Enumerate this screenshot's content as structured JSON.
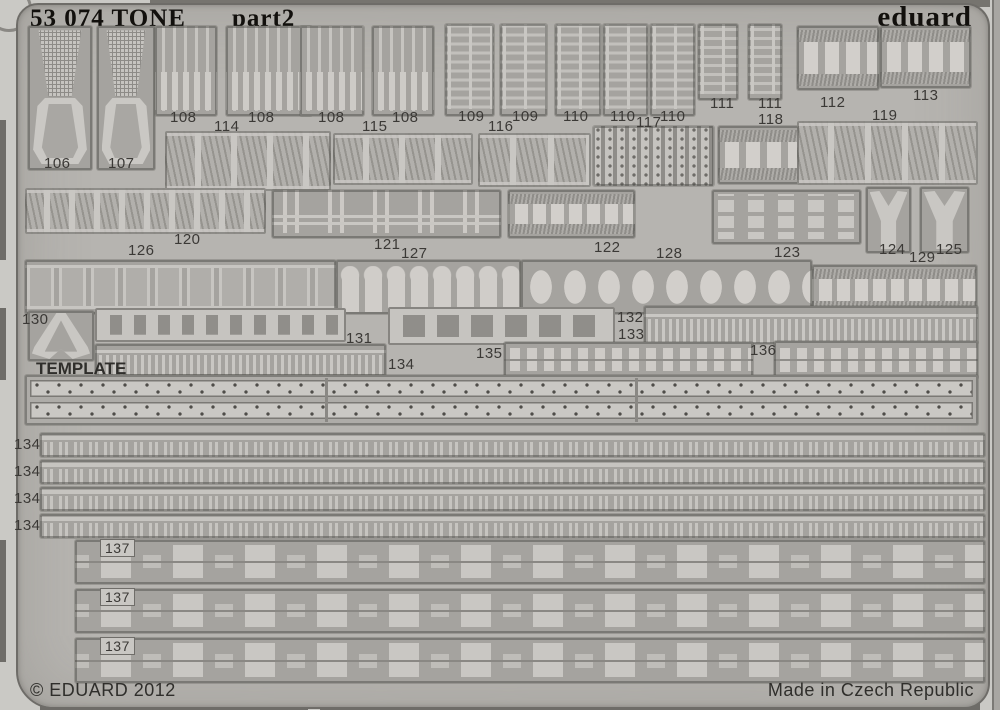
{
  "sheet": {
    "title": "53 074 TONE",
    "subtitle": "part2",
    "brand": "eduard",
    "template_label": "TEMPLATE",
    "copyright": "© EDUARD 2012",
    "made_in": "Made in Czech Republic"
  },
  "colors": {
    "background": "#cac9c5",
    "sheet": "#b6b4b0",
    "plate": "#a5a39f",
    "part_light": "#c9c7c3",
    "outline": "#55534f",
    "ink": "#12100d",
    "label": "#3b3936"
  },
  "part_labels": [
    "106",
    "107",
    "108",
    "114",
    "108",
    "108",
    "115",
    "108",
    "109",
    "116",
    "109",
    "110",
    "110",
    "117",
    "110",
    "111",
    "111",
    "118",
    "112",
    "113",
    "119",
    "120",
    "121",
    "122",
    "123",
    "124",
    "125",
    "126",
    "127",
    "128",
    "129",
    "130",
    "131",
    "132",
    "133",
    "135",
    "134",
    "136",
    "134",
    "134",
    "134",
    "134",
    "137",
    "137",
    "137"
  ]
}
